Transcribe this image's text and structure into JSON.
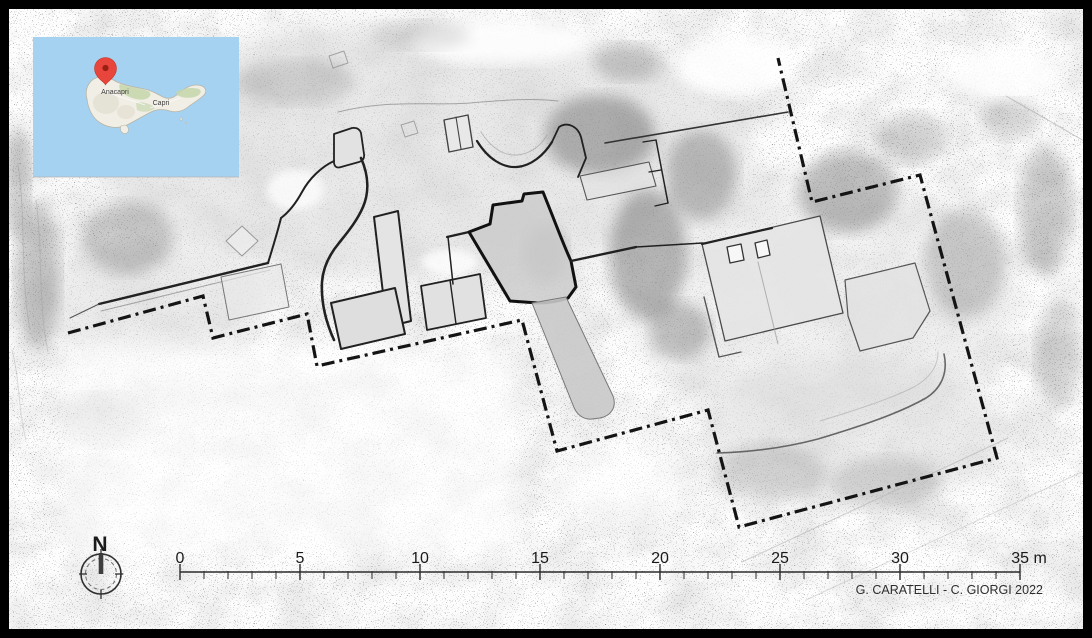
{
  "inset_map": {
    "labels": {
      "west_town": "Anacapri",
      "east_town": "Capri"
    },
    "colors": {
      "sea": "#a5d2f1",
      "land": "#f1eee5",
      "vegetation": "#c5d6ac",
      "pin": "#e8453c",
      "pin_core": "#991f12"
    }
  },
  "north_indicator": {
    "label": "N"
  },
  "scale_bar": {
    "labels": [
      "0",
      "5",
      "10",
      "15",
      "20",
      "25",
      "30",
      "35 m"
    ],
    "major_interval_m": 5,
    "minor_interval_m": 1
  },
  "credits": {
    "text": "G. CARATELLI - C. GIORGI 2022"
  },
  "plan": {
    "boundary_color": "#141414",
    "wall_color": "#212121",
    "bold_wall_color": "#111111",
    "paper_color": "#fdfdfd"
  }
}
